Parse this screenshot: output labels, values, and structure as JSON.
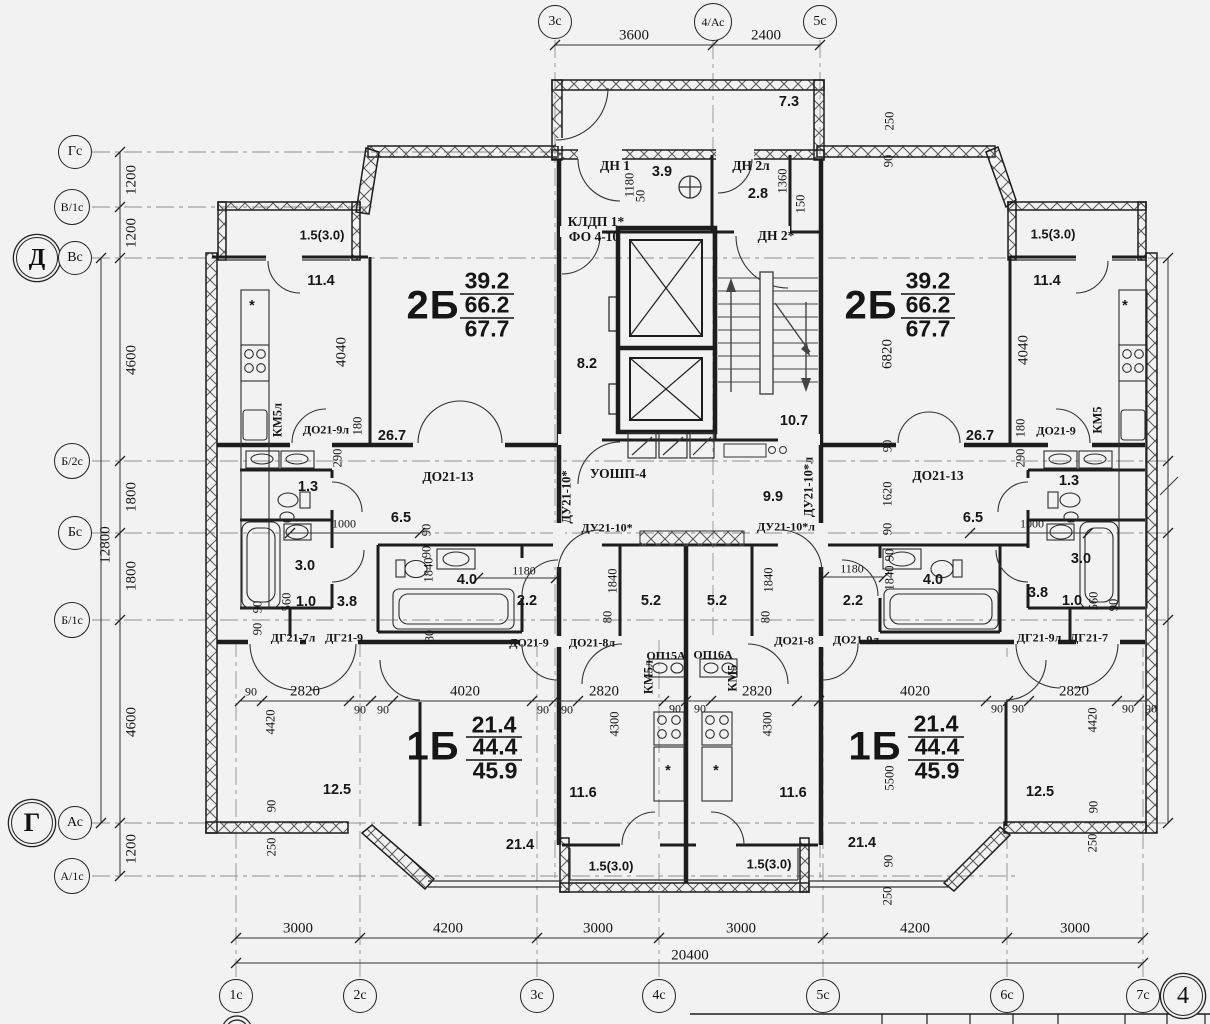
{
  "document": {
    "type": "architectural-floor-plan",
    "sheet_number": "4"
  },
  "colors": {
    "paper": "#f2f2f3",
    "ink": "#1c1c1c",
    "wall": "#1d1d1d",
    "axis": "#8f8f8f"
  },
  "apartments": [
    {
      "type": "2Б",
      "living_area": "39.2",
      "area": "66.2",
      "total_area": "67.7",
      "count": 2
    },
    {
      "type": "1Б",
      "living_area": "21.4",
      "area": "44.4",
      "total_area": "45.9",
      "count": 2
    }
  ],
  "axes": {
    "top": [
      {
        "label": "3с",
        "x": 555,
        "y": 22
      },
      {
        "label": "4/Ас",
        "x": 713,
        "y": 22,
        "r": 19,
        "fs": 12
      },
      {
        "label": "5с",
        "x": 820,
        "y": 22
      }
    ],
    "left": [
      {
        "label": "Гс",
        "x": 75,
        "y": 152
      },
      {
        "label": "В/1с",
        "x": 72,
        "y": 207,
        "r": 18,
        "fs": 12
      },
      {
        "label": "Д",
        "x": 37,
        "y": 258,
        "r": 21,
        "fs": 24,
        "double": true,
        "bold": true
      },
      {
        "label": "Вс",
        "x": 75,
        "y": 258
      },
      {
        "label": "Б/2с",
        "x": 72,
        "y": 461,
        "r": 18,
        "fs": 12
      },
      {
        "label": "Бс",
        "x": 75,
        "y": 533
      },
      {
        "label": "Б/1с",
        "x": 72,
        "y": 620,
        "r": 18,
        "fs": 12
      },
      {
        "label": "Г",
        "x": 32,
        "y": 823,
        "r": 21,
        "fs": 26,
        "double": true,
        "bold": true
      },
      {
        "label": "Ас",
        "x": 75,
        "y": 823
      },
      {
        "label": "А/1с",
        "x": 72,
        "y": 876,
        "r": 18,
        "fs": 12
      }
    ],
    "bottom": [
      {
        "label": "1с",
        "x": 236,
        "y": 996
      },
      {
        "label": "2с",
        "x": 360,
        "y": 996
      },
      {
        "label": "3с",
        "x": 537,
        "y": 996
      },
      {
        "label": "4с",
        "x": 659,
        "y": 996
      },
      {
        "label": "5с",
        "x": 823,
        "y": 996
      },
      {
        "label": "6с",
        "x": 1007,
        "y": 996
      },
      {
        "label": "7с",
        "x": 1143,
        "y": 996
      },
      {
        "label": "4",
        "x": 1183,
        "y": 996,
        "r": 20,
        "fs": 24,
        "double": true
      }
    ]
  },
  "labels": [
    {
      "t": "3600",
      "x": 634,
      "y": 36,
      "c": "d"
    },
    {
      "t": "2400",
      "x": 766,
      "y": 36,
      "c": "d"
    },
    {
      "t": "1200",
      "x": 132,
      "y": 180,
      "c": "dv"
    },
    {
      "t": "1200",
      "x": 132,
      "y": 233,
      "c": "dv"
    },
    {
      "t": "4600",
      "x": 132,
      "y": 360,
      "c": "dv"
    },
    {
      "t": "1800",
      "x": 132,
      "y": 497,
      "c": "dv"
    },
    {
      "t": "1800",
      "x": 132,
      "y": 576,
      "c": "dv"
    },
    {
      "t": "4600",
      "x": 132,
      "y": 722,
      "c": "dv"
    },
    {
      "t": "1200",
      "x": 132,
      "y": 849,
      "c": "dv"
    },
    {
      "t": "12800",
      "x": 106,
      "y": 545,
      "c": "dv"
    },
    {
      "t": "3000",
      "x": 298,
      "y": 929,
      "c": "d"
    },
    {
      "t": "4200",
      "x": 448,
      "y": 929,
      "c": "d"
    },
    {
      "t": "3000",
      "x": 598,
      "y": 929,
      "c": "d"
    },
    {
      "t": "3000",
      "x": 741,
      "y": 929,
      "c": "d"
    },
    {
      "t": "4200",
      "x": 915,
      "y": 929,
      "c": "d"
    },
    {
      "t": "3000",
      "x": 1075,
      "y": 929,
      "c": "d"
    },
    {
      "t": "20400",
      "x": 690,
      "y": 956,
      "c": "d"
    },
    {
      "t": "7.3",
      "x": 789,
      "y": 102,
      "c": "a"
    },
    {
      "t": "ДН 1",
      "x": 615,
      "y": 166,
      "c": "m"
    },
    {
      "t": "3.9",
      "x": 662,
      "y": 172,
      "c": "a"
    },
    {
      "t": "ДН 2л",
      "x": 751,
      "y": 166,
      "c": "m"
    },
    {
      "t": "2.8",
      "x": 758,
      "y": 194,
      "c": "a"
    },
    {
      "t": "ДН 2*",
      "x": 776,
      "y": 236,
      "c": "m"
    },
    {
      "t": "КЛДП 1*",
      "x": 596,
      "y": 222,
      "c": "m"
    },
    {
      "t": "ФО 4-10",
      "x": 594,
      "y": 237,
      "c": "m"
    },
    {
      "t": "1180",
      "x": 630,
      "y": 185,
      "c": "dvs"
    },
    {
      "t": "50",
      "x": 641,
      "y": 196,
      "c": "dvs"
    },
    {
      "t": "1360",
      "x": 783,
      "y": 181,
      "c": "dvs"
    },
    {
      "t": "150",
      "x": 801,
      "y": 204,
      "c": "dvs"
    },
    {
      "t": "250",
      "x": 890,
      "y": 121,
      "c": "dvs"
    },
    {
      "t": "90",
      "x": 889,
      "y": 161,
      "c": "dvs"
    },
    {
      "t": "8.2",
      "x": 587,
      "y": 364,
      "c": "a"
    },
    {
      "t": "10.7",
      "x": 794,
      "y": 421,
      "c": "a"
    },
    {
      "t": "УОШП-4",
      "x": 618,
      "y": 474,
      "c": "m"
    },
    {
      "t": "9.9",
      "x": 773,
      "y": 497,
      "c": "a"
    },
    {
      "t": "1.5(3.0)",
      "x": 322,
      "y": 235,
      "c": "a13"
    },
    {
      "t": "11.4",
      "x": 321,
      "y": 281,
      "c": "a"
    },
    {
      "t": "2Б",
      "x": 433,
      "y": 306,
      "c": "apt"
    },
    {
      "t": "39.2",
      "x": 487,
      "y": 281,
      "c": "apt2"
    },
    {
      "t": "66.2",
      "x": 487,
      "y": 305,
      "c": "apt2"
    },
    {
      "t": "67.7",
      "x": 487,
      "y": 329,
      "c": "apt2"
    },
    {
      "t": "4040",
      "x": 342,
      "y": 352,
      "c": "dv"
    },
    {
      "t": "КМ5л",
      "x": 278,
      "y": 420,
      "c": "mv"
    },
    {
      "t": "ДО21-9л",
      "x": 326,
      "y": 430,
      "c": "ms"
    },
    {
      "t": "180",
      "x": 358,
      "y": 426,
      "c": "dvs"
    },
    {
      "t": "290",
      "x": 338,
      "y": 458,
      "c": "dvs"
    },
    {
      "t": "26.7",
      "x": 392,
      "y": 436,
      "c": "a"
    },
    {
      "t": "ДО21-13",
      "x": 448,
      "y": 477,
      "c": "m"
    },
    {
      "t": "1.3",
      "x": 308,
      "y": 487,
      "c": "a"
    },
    {
      "t": "1000",
      "x": 344,
      "y": 524,
      "c": "ds"
    },
    {
      "t": "6.5",
      "x": 401,
      "y": 518,
      "c": "a"
    },
    {
      "t": "3.0",
      "x": 305,
      "y": 566,
      "c": "a"
    },
    {
      "t": "560",
      "x": 287,
      "y": 602,
      "c": "dvs"
    },
    {
      "t": "1.0",
      "x": 306,
      "y": 602,
      "c": "a"
    },
    {
      "t": "3.8",
      "x": 347,
      "y": 602,
      "c": "a"
    },
    {
      "t": "90",
      "x": 258,
      "y": 607,
      "c": "dvs"
    },
    {
      "t": "90",
      "x": 258,
      "y": 629,
      "c": "dvs"
    },
    {
      "t": "ДГ21-7л",
      "x": 293,
      "y": 638,
      "c": "ms"
    },
    {
      "t": "ДГ21-9",
      "x": 344,
      "y": 638,
      "c": "ms"
    },
    {
      "t": "1840",
      "x": 429,
      "y": 570,
      "c": "dvs"
    },
    {
      "t": "90",
      "x": 427,
      "y": 552,
      "c": "dvs"
    },
    {
      "t": "90",
      "x": 427,
      "y": 530,
      "c": "dvs"
    },
    {
      "t": "4.0",
      "x": 467,
      "y": 580,
      "c": "a"
    },
    {
      "t": "1180",
      "x": 524,
      "y": 571,
      "c": "ds"
    },
    {
      "t": "2.2",
      "x": 527,
      "y": 601,
      "c": "a"
    },
    {
      "t": "80",
      "x": 430,
      "y": 636,
      "c": "dvs"
    },
    {
      "t": "ДО21-9",
      "x": 529,
      "y": 643,
      "c": "ms"
    },
    {
      "t": "ДО21-8л",
      "x": 592,
      "y": 643,
      "c": "ms"
    },
    {
      "t": "ДУ21-10*",
      "x": 567,
      "y": 497,
      "c": "mv"
    },
    {
      "t": "ДУ21-10*",
      "x": 607,
      "y": 528,
      "c": "ms"
    },
    {
      "t": "ДУ21-10*л",
      "x": 786,
      "y": 527,
      "c": "ms"
    },
    {
      "t": "ДУ21-10*л",
      "x": 809,
      "y": 487,
      "c": "mv"
    },
    {
      "t": "1840",
      "x": 613,
      "y": 581,
      "c": "dvs"
    },
    {
      "t": "1840",
      "x": 769,
      "y": 580,
      "c": "dvs"
    },
    {
      "t": "5.2",
      "x": 651,
      "y": 601,
      "c": "a"
    },
    {
      "t": "5.2",
      "x": 717,
      "y": 601,
      "c": "a"
    },
    {
      "t": "80",
      "x": 608,
      "y": 617,
      "c": "dvs"
    },
    {
      "t": "80",
      "x": 766,
      "y": 617,
      "c": "dvs"
    },
    {
      "t": "ДО21-8",
      "x": 794,
      "y": 641,
      "c": "ms"
    },
    {
      "t": "ДО21-9л",
      "x": 856,
      "y": 640,
      "c": "ms"
    },
    {
      "t": "ОП15А",
      "x": 666,
      "y": 656,
      "c": "ms"
    },
    {
      "t": "ОП16А",
      "x": 713,
      "y": 655,
      "c": "ms"
    },
    {
      "t": "КМ5л",
      "x": 649,
      "y": 677,
      "c": "mv"
    },
    {
      "t": "КМ5",
      "x": 733,
      "y": 678,
      "c": "mv"
    },
    {
      "t": "2Б",
      "x": 871,
      "y": 306,
      "c": "apt"
    },
    {
      "t": "39.2",
      "x": 928,
      "y": 281,
      "c": "apt2"
    },
    {
      "t": "66.2",
      "x": 928,
      "y": 305,
      "c": "apt2"
    },
    {
      "t": "67.7",
      "x": 928,
      "y": 329,
      "c": "apt2"
    },
    {
      "t": "6820",
      "x": 888,
      "y": 354,
      "c": "dv"
    },
    {
      "t": "1.5(3.0)",
      "x": 1053,
      "y": 234,
      "c": "a13"
    },
    {
      "t": "11.4",
      "x": 1047,
      "y": 281,
      "c": "a"
    },
    {
      "t": "4040",
      "x": 1024,
      "y": 350,
      "c": "dv"
    },
    {
      "t": "КМ5",
      "x": 1098,
      "y": 420,
      "c": "mv"
    },
    {
      "t": "ДО21-9",
      "x": 1056,
      "y": 431,
      "c": "ms"
    },
    {
      "t": "180",
      "x": 1021,
      "y": 428,
      "c": "dvs"
    },
    {
      "t": "290",
      "x": 1021,
      "y": 458,
      "c": "dvs"
    },
    {
      "t": "26.7",
      "x": 980,
      "y": 436,
      "c": "a"
    },
    {
      "t": "ДО21-13",
      "x": 938,
      "y": 476,
      "c": "m"
    },
    {
      "t": "90",
      "x": 888,
      "y": 446,
      "c": "dvs"
    },
    {
      "t": "1620",
      "x": 888,
      "y": 494,
      "c": "dvs"
    },
    {
      "t": "90",
      "x": 888,
      "y": 529,
      "c": "dvs"
    },
    {
      "t": "6.5",
      "x": 973,
      "y": 518,
      "c": "a"
    },
    {
      "t": "1.3",
      "x": 1069,
      "y": 481,
      "c": "a"
    },
    {
      "t": "1000",
      "x": 1032,
      "y": 524,
      "c": "ds"
    },
    {
      "t": "3.0",
      "x": 1081,
      "y": 559,
      "c": "a"
    },
    {
      "t": "1840",
      "x": 890,
      "y": 578,
      "c": "dvs"
    },
    {
      "t": "90",
      "x": 890,
      "y": 555,
      "c": "dvs"
    },
    {
      "t": "4.0",
      "x": 933,
      "y": 580,
      "c": "a"
    },
    {
      "t": "1180",
      "x": 852,
      "y": 569,
      "c": "ds"
    },
    {
      "t": "2.2",
      "x": 853,
      "y": 601,
      "c": "a"
    },
    {
      "t": "3.8",
      "x": 1038,
      "y": 593,
      "c": "a"
    },
    {
      "t": "1.0",
      "x": 1072,
      "y": 601,
      "c": "a"
    },
    {
      "t": "560",
      "x": 1094,
      "y": 601,
      "c": "dvs"
    },
    {
      "t": "90",
      "x": 1114,
      "y": 605,
      "c": "dvs"
    },
    {
      "t": "ДГ21-9л",
      "x": 1039,
      "y": 638,
      "c": "ms"
    },
    {
      "t": "ДГ21-7",
      "x": 1089,
      "y": 638,
      "c": "ms"
    },
    {
      "t": "90",
      "x": 251,
      "y": 692,
      "c": "ds"
    },
    {
      "t": "2820",
      "x": 305,
      "y": 692,
      "c": "d"
    },
    {
      "t": "4020",
      "x": 465,
      "y": 692,
      "c": "d"
    },
    {
      "t": "90",
      "x": 360,
      "y": 710,
      "c": "ds"
    },
    {
      "t": "90",
      "x": 383,
      "y": 710,
      "c": "ds"
    },
    {
      "t": "4420",
      "x": 271,
      "y": 722,
      "c": "dvs"
    },
    {
      "t": "1Б",
      "x": 433,
      "y": 747,
      "c": "apt"
    },
    {
      "t": "21.4",
      "x": 494,
      "y": 725,
      "c": "apt2"
    },
    {
      "t": "44.4",
      "x": 495,
      "y": 747,
      "c": "apt2"
    },
    {
      "t": "45.9",
      "x": 495,
      "y": 771,
      "c": "apt2"
    },
    {
      "t": "12.5",
      "x": 337,
      "y": 790,
      "c": "a"
    },
    {
      "t": "90",
      "x": 272,
      "y": 806,
      "c": "dvs"
    },
    {
      "t": "250",
      "x": 272,
      "y": 847,
      "c": "dvs"
    },
    {
      "t": "21.4",
      "x": 520,
      "y": 845,
      "c": "a"
    },
    {
      "t": "90",
      "x": 543,
      "y": 710,
      "c": "ds"
    },
    {
      "t": "90",
      "x": 567,
      "y": 710,
      "c": "ds"
    },
    {
      "t": "2820",
      "x": 604,
      "y": 692,
      "c": "d"
    },
    {
      "t": "90",
      "x": 675,
      "y": 709,
      "c": "ds"
    },
    {
      "t": "90",
      "x": 700,
      "y": 709,
      "c": "ds"
    },
    {
      "t": "4300",
      "x": 615,
      "y": 724,
      "c": "dvs"
    },
    {
      "t": "11.6",
      "x": 583,
      "y": 793,
      "c": "a"
    },
    {
      "t": "1.5(3.0)",
      "x": 611,
      "y": 866,
      "c": "a13"
    },
    {
      "t": "1.5(3.0)",
      "x": 769,
      "y": 864,
      "c": "a13"
    },
    {
      "t": "2820",
      "x": 757,
      "y": 692,
      "c": "d"
    },
    {
      "t": "4300",
      "x": 768,
      "y": 724,
      "c": "dvs"
    },
    {
      "t": "11.6",
      "x": 793,
      "y": 793,
      "c": "a"
    },
    {
      "t": "90",
      "x": 889,
      "y": 861,
      "c": "dvs"
    },
    {
      "t": "250",
      "x": 888,
      "y": 896,
      "c": "dvs"
    },
    {
      "t": "4020",
      "x": 915,
      "y": 692,
      "c": "d"
    },
    {
      "t": "2820",
      "x": 1074,
      "y": 692,
      "c": "d"
    },
    {
      "t": "90",
      "x": 997,
      "y": 709,
      "c": "ds"
    },
    {
      "t": "90",
      "x": 1018,
      "y": 709,
      "c": "ds"
    },
    {
      "t": "90",
      "x": 1128,
      "y": 709,
      "c": "ds"
    },
    {
      "t": "90",
      "x": 1151,
      "y": 709,
      "c": "ds"
    },
    {
      "t": "4420",
      "x": 1093,
      "y": 720,
      "c": "dvs"
    },
    {
      "t": "1Б",
      "x": 875,
      "y": 747,
      "c": "apt"
    },
    {
      "t": "21.4",
      "x": 936,
      "y": 724,
      "c": "apt2"
    },
    {
      "t": "44.4",
      "x": 937,
      "y": 747,
      "c": "apt2"
    },
    {
      "t": "45.9",
      "x": 937,
      "y": 771,
      "c": "apt2"
    },
    {
      "t": "5500",
      "x": 890,
      "y": 778,
      "c": "dvs"
    },
    {
      "t": "12.5",
      "x": 1040,
      "y": 792,
      "c": "a"
    },
    {
      "t": "90",
      "x": 1094,
      "y": 807,
      "c": "dvs"
    },
    {
      "t": "250",
      "x": 1093,
      "y": 843,
      "c": "dvs"
    },
    {
      "t": "21.4",
      "x": 862,
      "y": 843,
      "c": "a"
    },
    {
      "t": "*",
      "x": 252,
      "y": 306,
      "c": "a"
    },
    {
      "t": "*",
      "x": 1125,
      "y": 306,
      "c": "a"
    },
    {
      "t": "*",
      "x": 668,
      "y": 771,
      "c": "a"
    },
    {
      "t": "*",
      "x": 716,
      "y": 771,
      "c": "a"
    }
  ]
}
